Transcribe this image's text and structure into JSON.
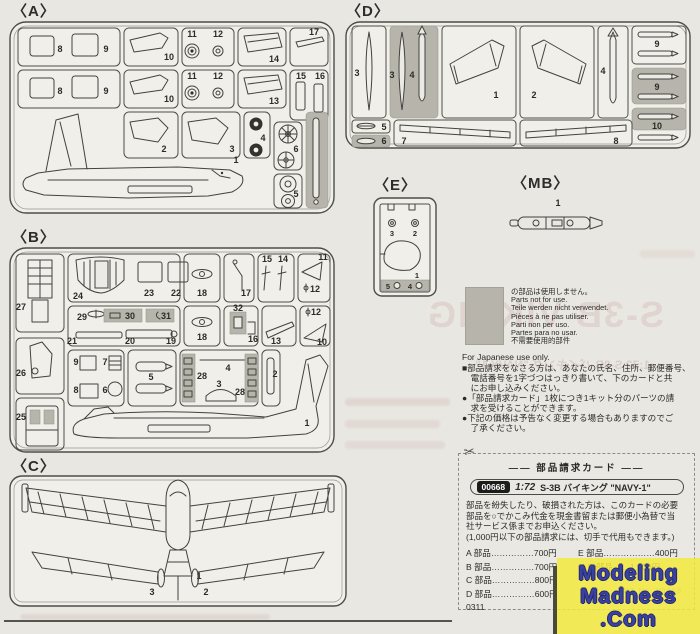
{
  "sprues": {
    "a": {
      "label": "〈A〉",
      "nums": [
        "8",
        "9",
        "10",
        "11",
        "12",
        "14",
        "17",
        "8",
        "9",
        "10",
        "11",
        "12",
        "13",
        "15",
        "16",
        "2",
        "3",
        "4",
        "6",
        "5",
        "1"
      ]
    },
    "b": {
      "label": "〈B〉",
      "nums": [
        "27",
        "26",
        "25",
        "24",
        "23",
        "22",
        "18",
        "17",
        "15",
        "14",
        "11",
        "12",
        "29",
        "30",
        "31",
        "21",
        "20",
        "19",
        "18",
        "32",
        "16",
        "13",
        "12",
        "10",
        "9",
        "7",
        "8",
        "6",
        "5",
        "28",
        "4",
        "3",
        "28",
        "2",
        "1"
      ]
    },
    "c": {
      "label": "〈C〉",
      "nums": [
        "1",
        "3",
        "2"
      ]
    },
    "d": {
      "label": "〈D〉",
      "nums": [
        "3",
        "3",
        "4",
        "1",
        "2",
        "4",
        "9",
        "9",
        "10",
        "5",
        "6",
        "7",
        "8"
      ]
    },
    "e": {
      "label": "〈E〉",
      "nums": [
        "3",
        "2",
        "1",
        "5",
        "4"
      ]
    },
    "mb": {
      "label": "〈MB〉",
      "nums": [
        "1"
      ]
    }
  },
  "notes": {
    "unused": [
      "の部品は使用しません。",
      "Parts not for use.",
      "Teile werden nicht verwendet.",
      "Pièces à ne pas utiliser.",
      "Parti non per uso.",
      "Partes para no usar.",
      "不需要使用的部件"
    ],
    "jp_only": "For Japanese use only.",
    "bullets": [
      "■部品請求をなさる方は、あなたの氏名、住所、郵便番号、",
      "　電話番号を1字づつはっきり書いて、下のカードと共",
      "　にお申し込みください。",
      "●「部品請求カード」1枚につき1キット分のパーツの請",
      "　求を受けることができます。",
      "●下記の価格は予告なく変更する場合もありますのでご",
      "　了承ください。"
    ]
  },
  "card": {
    "scissors": "✂",
    "title": "―― 部品請求カード ――",
    "code": "00668",
    "scale": "1:72",
    "kit_name": "S-3B バイキング \"NAVY-1\"",
    "body": [
      "部品を紛失したり、破損された方は、このカードの必要",
      "部品を○でかこみ代金を現金書留または郵便小為替で当",
      "社サービス係までお申込ください。",
      "(1,000円以下の部品請求には、切手で代用もできます。)"
    ],
    "prices_left": [
      "A 部品……………700円",
      "B 部品……………700円",
      "C 部品……………800円",
      "D 部品……………600円"
    ],
    "prices_right": [
      "E 部品………………400円",
      "M B 部品……1,600円"
    ],
    "date_code": "0311",
    "art_no": "ART No. 00668"
  },
  "watermark": {
    "line1": "Modeling",
    "line2": "Madness",
    "line3": ".Com"
  },
  "bleed": {
    "big": "S-3B VIKING",
    "card": "1:72 S-3B バイキング \"NAVY-1\""
  },
  "colors": {
    "paper": "#e9e7e1",
    "sprue_fill": "#f0efe9",
    "line": "#4e4d48",
    "unused_shade": "#b6b4ab",
    "watermark_bg": "#f3e93e",
    "watermark_text": "#3a41a3"
  }
}
